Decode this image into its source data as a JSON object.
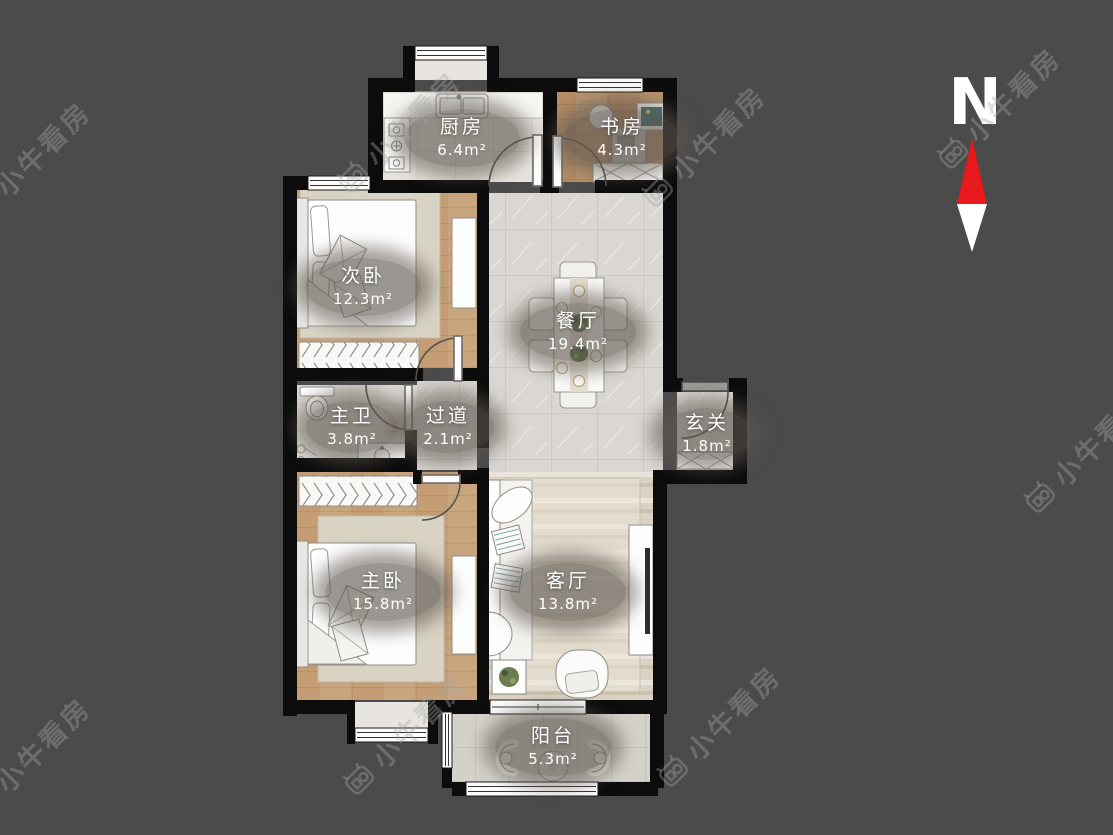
{
  "plan_title": "apartment floor plan",
  "compass": {
    "label": "N",
    "north_color": "#e8191c",
    "south_color": "#ffffff"
  },
  "watermark": {
    "text": "小牛看房"
  },
  "rooms": [
    {
      "id": "kitchen",
      "name": "厨房",
      "area": "6.4m²"
    },
    {
      "id": "study",
      "name": "书房",
      "area": "4.3m²"
    },
    {
      "id": "second-bedroom",
      "name": "次卧",
      "area": "12.3m²"
    },
    {
      "id": "dining-room",
      "name": "餐厅",
      "area": "19.4m²"
    },
    {
      "id": "master-bathroom",
      "name": "主卫",
      "area": "3.8m²"
    },
    {
      "id": "hallway",
      "name": "过道",
      "area": "2.1m²"
    },
    {
      "id": "entryway",
      "name": "玄关",
      "area": "1.8m²"
    },
    {
      "id": "master-bedroom",
      "name": "主卧",
      "area": "15.8m²"
    },
    {
      "id": "living-room",
      "name": "客厅",
      "area": "13.8m²"
    },
    {
      "id": "balcony",
      "name": "阳台",
      "area": "5.3m²"
    }
  ],
  "palette": {
    "background": "#4b4b4c",
    "wall": "#0c0c0c",
    "marble_floor": "#dad7d2",
    "bedroom_wood_floor": "#c49d75",
    "study_wood_floor": "#b58d66",
    "living_wash_floor": "#dbd2c4",
    "kitchen_tile": "#e7e4df",
    "balcony_tile": "#d4d1cb",
    "label_pill": "#5c574f",
    "compass_north": "#e8191c",
    "watermark_gray": "#a5a5a5"
  }
}
